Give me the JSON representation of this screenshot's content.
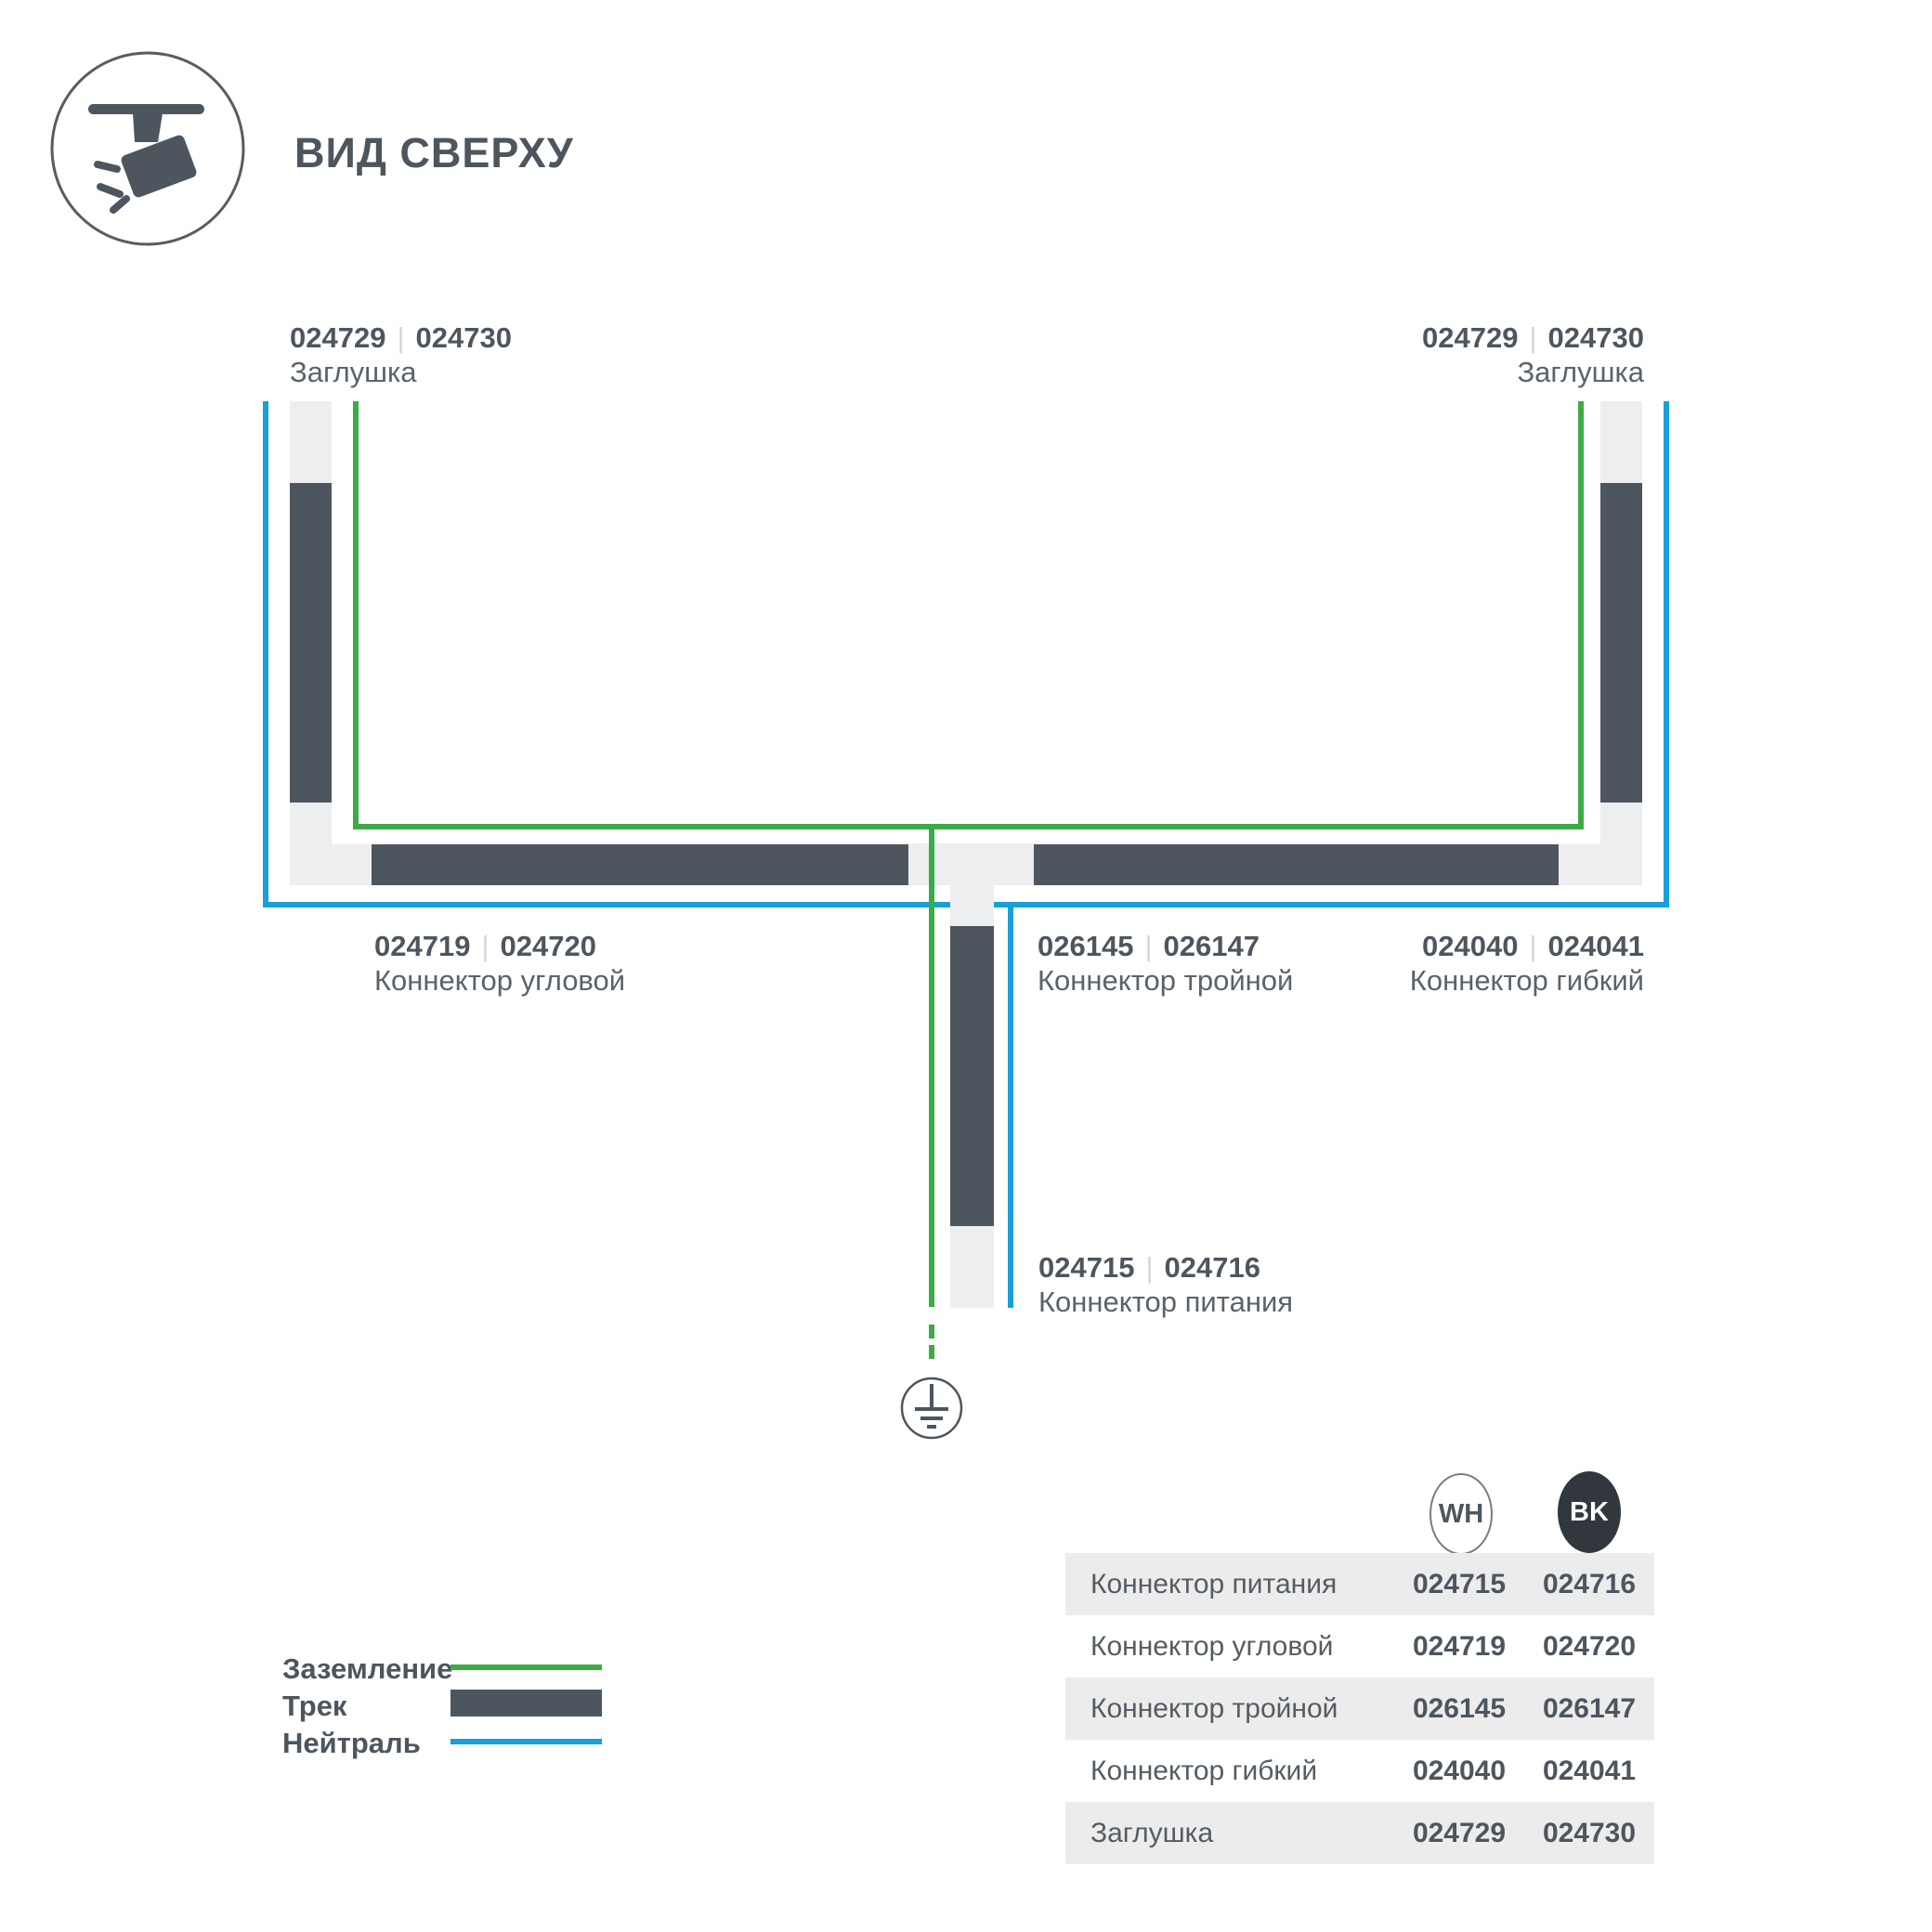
{
  "page": {
    "title": "ВИД СВЕРХУ"
  },
  "diagram": {
    "sep": "|",
    "cap_left": {
      "wh": "024729",
      "bk": "024730",
      "label": "Заглушка"
    },
    "cap_right": {
      "wh": "024729",
      "bk": "024730",
      "label": "Заглушка"
    },
    "corner": {
      "wh": "024719",
      "bk": "024720",
      "label": "Коннектор угловой"
    },
    "triple": {
      "wh": "026145",
      "bk": "026147",
      "label": "Коннектор тройной"
    },
    "flex": {
      "wh": "024040",
      "bk": "024041",
      "label": "Коннектор гибкий"
    },
    "power": {
      "wh": "024715",
      "bk": "024716",
      "label": "Коннектор питания"
    }
  },
  "legend": {
    "ground_label": "Заземление",
    "track_label": "Трек",
    "neutral_label": "Нейтраль"
  },
  "table": {
    "col_wh": "WH",
    "col_bk": "BK",
    "rows": [
      {
        "name": "Коннектор питания",
        "wh": "024715",
        "bk": "024716"
      },
      {
        "name": "Коннектор угловой",
        "wh": "024719",
        "bk": "024720"
      },
      {
        "name": "Коннектор тройной",
        "wh": "026145",
        "bk": "026147"
      },
      {
        "name": "Коннектор гибкий",
        "wh": "024040",
        "bk": "024041"
      },
      {
        "name": "Заглушка",
        "wh": "024729",
        "bk": "024730"
      }
    ]
  },
  "colors": {
    "ground_green": "#3dab44",
    "neutral_blue": "#17a0da",
    "track_dark": "#4d565e",
    "connector_light": "#eceef0",
    "table_row_gray": "#ececec",
    "bk_badge": "#31373c"
  }
}
